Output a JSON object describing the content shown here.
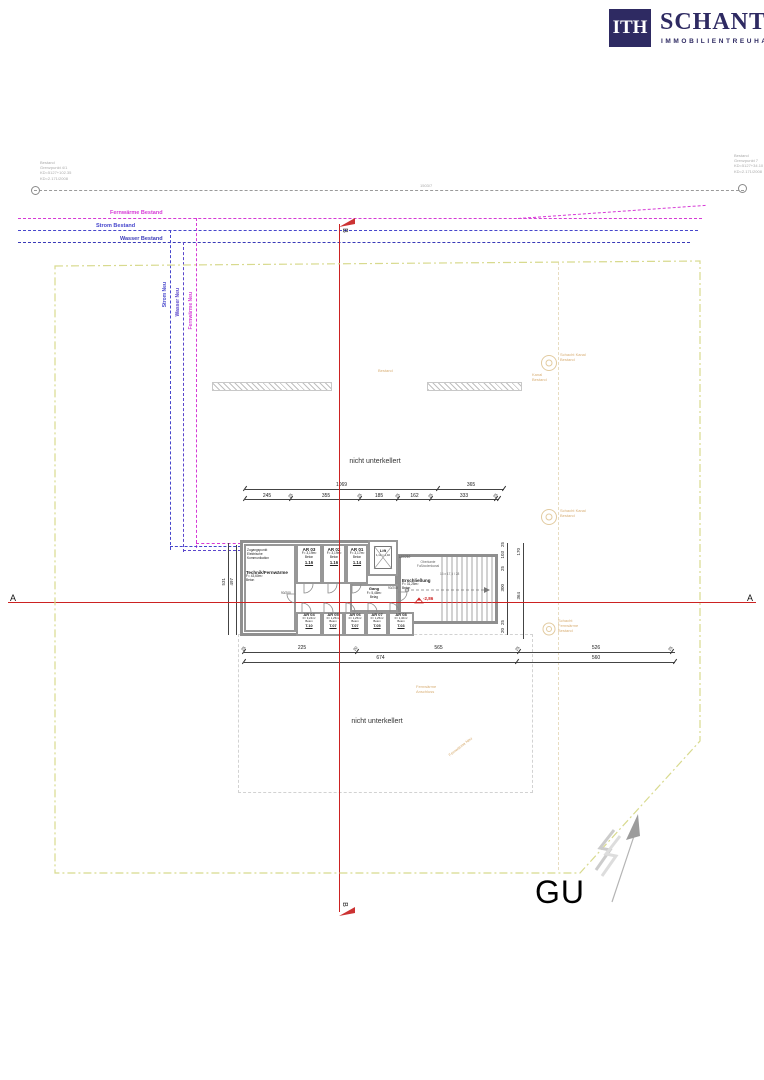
{
  "logo": {
    "mark": "ITH",
    "name": "SCHANTL",
    "subtitle": "IMMOBILIENTREUHAND"
  },
  "colors": {
    "brand": "#2e2a62",
    "fernwaerme": "#d63ad6",
    "strom": "#4646cc",
    "wasser": "#3a3ab8",
    "section_red": "#cc2222",
    "boundary": "#d8da8e",
    "faint_orange": "#d8ae74"
  },
  "survey": {
    "left_note": [
      "Bestand",
      "Grenzpunkt 4/1",
      "KD=5127+102.35",
      "KD=2.171/2008"
    ],
    "right_note": [
      "Bestand",
      "Grenzpunkt 7",
      "KD=5127+34.10",
      "KD=2.171/2008"
    ],
    "parcel": "1503/7"
  },
  "utilities": {
    "fernwaerme_bestand": "Fernwärme Bestand",
    "strom_bestand": "Strom Bestand",
    "wasser_bestand": "Wasser Bestand",
    "strom_neu": "Strom Neu",
    "wasser_neu": "Wasser Neu",
    "fernwaerme_neu": "Fernwärme Neu"
  },
  "sections": {
    "a": "A",
    "b": "B"
  },
  "notes": {
    "nicht_unterkellert": "nicht unterkellert",
    "gu": "GU"
  },
  "plan": {
    "zugang": [
      "Zugangspunkt",
      "Elektrische",
      "Kommunikation"
    ],
    "technik": {
      "name": "Technik/Fernwärme",
      "area": "F= 43,60m²",
      "mat": "Beton"
    },
    "rooms_top": [
      {
        "name": "AR 03",
        "area": "F= 3,19m²",
        "mat": "Beton",
        "unit": "1.16"
      },
      {
        "name": "AR 02",
        "area": "F= 3,19m²",
        "mat": "Beton",
        "unit": "1.16"
      },
      {
        "name": "AR 01",
        "area": "F= 3,17m²",
        "mat": "Beton",
        "unit": "1.14"
      }
    ],
    "rooms_bottom": [
      {
        "name": "AR 04",
        "area": "F= 3,24m²",
        "mat": "Beton",
        "unit": "T.10"
      },
      {
        "name": "AR 05",
        "area": "F= 1,25m²",
        "mat": "Beton",
        "unit": "T.07"
      },
      {
        "name": "AR 06",
        "area": "F= 1,25m²",
        "mat": "Beton",
        "unit": "T.07"
      },
      {
        "name": "AR 07",
        "area": "F= 1,25m²",
        "mat": "Beton",
        "unit": "T.05"
      },
      {
        "name": "AR 08",
        "area": "F= 1,40m²",
        "mat": "Beton",
        "unit": "T.03"
      }
    ],
    "gang": {
      "name": "Gang",
      "area": "F= 5,48m²",
      "mat": "Belag"
    },
    "lift": {
      "name": "Lift",
      "dims": "1,10 × 1,40"
    },
    "ersch": {
      "name": "Erschließung",
      "area": "F= 31,25m²",
      "mat": "Beton"
    },
    "level": "-2,86",
    "doors": {
      "technik": "90/200",
      "lift": "110/210",
      "gang": "90/200"
    },
    "stair_note": "16 x 17,5 / 28",
    "kanal_note": [
      "Oberkante",
      "Fußbodenkanal"
    ]
  },
  "dims": {
    "top_row1": [
      "1069",
      "365"
    ],
    "top_row2": [
      "245",
      "25",
      "355",
      "25",
      "185",
      "25",
      "162",
      "25",
      "333",
      "25"
    ],
    "bottom_row1": [
      "25",
      "225",
      "20",
      "565",
      "25",
      "526",
      "25"
    ],
    "bottom_row2": [
      "674",
      "560"
    ],
    "left": [
      "531",
      "497"
    ],
    "right_inner": [
      "25",
      "103",
      "25",
      "300",
      "25",
      "20"
    ],
    "right_outer": [
      "170",
      "364"
    ]
  },
  "faint": {
    "m1": [
      "Schacht Kanal",
      "Bestand"
    ],
    "m1b": [
      "Kanal",
      "Bestand"
    ],
    "m2": [
      "Schacht Kanal",
      "Bestand"
    ],
    "m3": [
      "Schacht",
      "Fernwärme",
      "Bestand"
    ],
    "strip": "Bestand",
    "fw": [
      "Fernwärme",
      "Anschluss"
    ],
    "fw2": "Fernwärme Neu"
  }
}
